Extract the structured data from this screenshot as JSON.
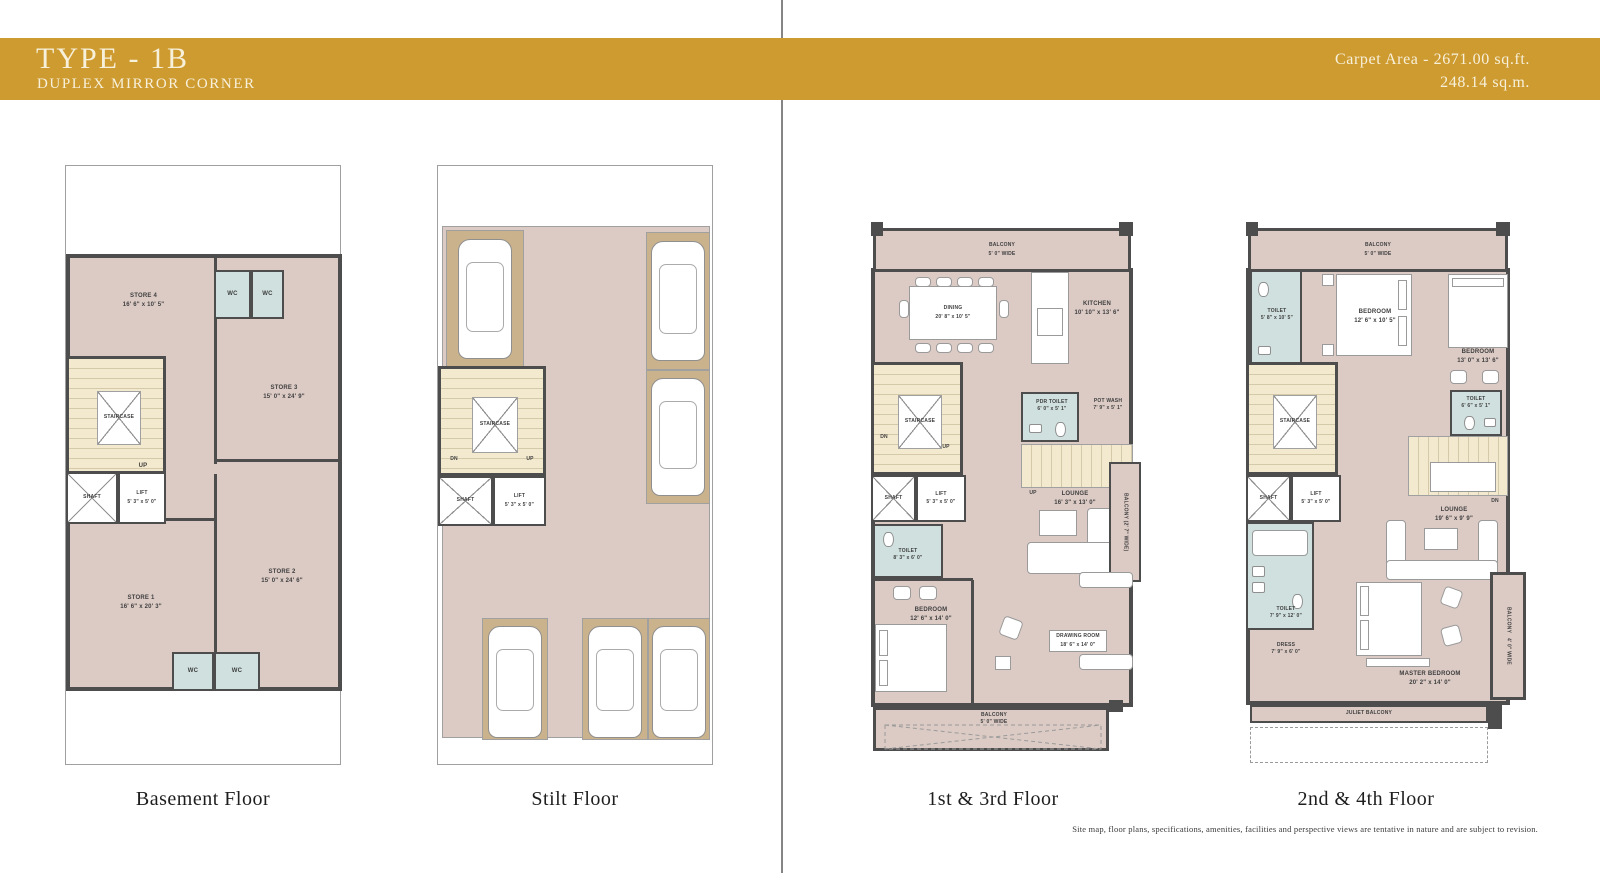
{
  "header": {
    "title": "TYPE - 1B",
    "subtitle": "DUPLEX MIRROR CORNER",
    "carpet_area_line1": "Carpet Area - 2671.00 sq.ft.",
    "carpet_area_line2": "248.14 sq.m."
  },
  "colors": {
    "accent_gold": "#CE9B31",
    "room_fill": "#DCCBC5",
    "wet_area_fill": "#CFE0DE",
    "parking_fill": "#C9B28C",
    "stair_fill": "#F3E9CE",
    "wall": "#4D4D4D"
  },
  "footer": {
    "disclaimer": "Site map, floor plans, specifications, amenities, facilities and perspective views are tentative in nature and are subject to revision."
  },
  "plans": {
    "basement": {
      "caption": "Basement Floor",
      "staircase": "STAIRCASE",
      "up": "UP",
      "shaft": "SHAFT",
      "wc": "WC",
      "lift": {
        "name": "LIFT",
        "dim": "5' 3\" x 5' 0\""
      },
      "store4": {
        "name": "STORE 4",
        "dim": "16' 6\" x 10' 5\""
      },
      "store3": {
        "name": "STORE 3",
        "dim": "15' 0\" x 24' 9\""
      },
      "store1": {
        "name": "STORE 1",
        "dim": "16' 6\" x 20' 3\""
      },
      "store2": {
        "name": "STORE 2",
        "dim": "15' 0\" x 24' 6\""
      }
    },
    "stilt": {
      "caption": "Stilt Floor",
      "staircase": "STAIRCASE",
      "dn": "DN",
      "up": "UP",
      "shaft": "SHAFT",
      "lift": {
        "name": "LIFT",
        "dim": "5' 3\" x 5' 0\""
      }
    },
    "first_third": {
      "caption": "1st & 3rd Floor",
      "staircase": "STAIRCASE",
      "dn": "DN",
      "up": "UP",
      "up2": "UP",
      "shaft": "SHAFT",
      "lift": {
        "name": "LIFT",
        "dim": "5' 3\" x 5' 0\""
      },
      "balcony_top": {
        "name": "BALCONY",
        "dim": "5' 0\" WIDE"
      },
      "dining": {
        "name": "DINING",
        "dim": "20' 8\" x 10' 5\""
      },
      "kitchen": {
        "name": "KITCHEN",
        "dim": "10' 10\" x 13' 6\""
      },
      "pdr_toilet": {
        "name": "PDR TOILET",
        "dim": "6' 0\" x 5' 1\""
      },
      "pot_wash": {
        "name": "POT WASH",
        "dim": "7' 9\" x 5' 1\""
      },
      "toilet": {
        "name": "TOILET",
        "dim": "8' 3\" x 6' 0\""
      },
      "lounge": {
        "name": "LOUNGE",
        "dim": "16' 3\" x 13' 0\""
      },
      "balcony_right": "BALCONY (2' 7\" WIDE)",
      "bedroom": {
        "name": "BEDROOM",
        "dim": "12' 6\" x 14' 0\""
      },
      "drawing_room": {
        "name": "DRAWING ROOM",
        "dim": "18' 6\" x 14' 0\""
      },
      "balcony_bottom": {
        "name": "BALCONY",
        "dim": "5' 0\" WIDE"
      }
    },
    "second_fourth": {
      "caption": "2nd & 4th Floor",
      "staircase": "STAIRCASE",
      "dn": "DN",
      "shaft": "SHAFT",
      "lift": {
        "name": "LIFT",
        "dim": "5' 3\" x 5' 0\""
      },
      "balcony_top": {
        "name": "BALCONY",
        "dim": "5' 0\" WIDE"
      },
      "toilet1": {
        "name": "TOILET",
        "dim": "5' 8\" x 10' 5\""
      },
      "bedroom1": {
        "name": "BEDROOM",
        "dim": "12' 6\" x 10' 5\""
      },
      "bedroom2": {
        "name": "BEDROOM",
        "dim": "13' 0\" x 13' 6\""
      },
      "toilet2": {
        "name": "TOILET",
        "dim": "6' 6\" x 5' 1\""
      },
      "toilet3": {
        "name": "TOILET",
        "dim": "7' 9\" x 12' 0\""
      },
      "dress": {
        "name": "DRESS",
        "dim": "7' 9\" x 6' 0\""
      },
      "lounge": {
        "name": "LOUNGE",
        "dim": "19' 6\" x 9' 9\""
      },
      "master_bedroom": {
        "name": "MASTER BEDROOM",
        "dim": "20' 2\" x 14' 0\""
      },
      "balcony_right": {
        "name": "BALCONY",
        "dim": "4' 0\" WIDE"
      },
      "juliet_balcony": "JULIET BALCONY"
    }
  }
}
